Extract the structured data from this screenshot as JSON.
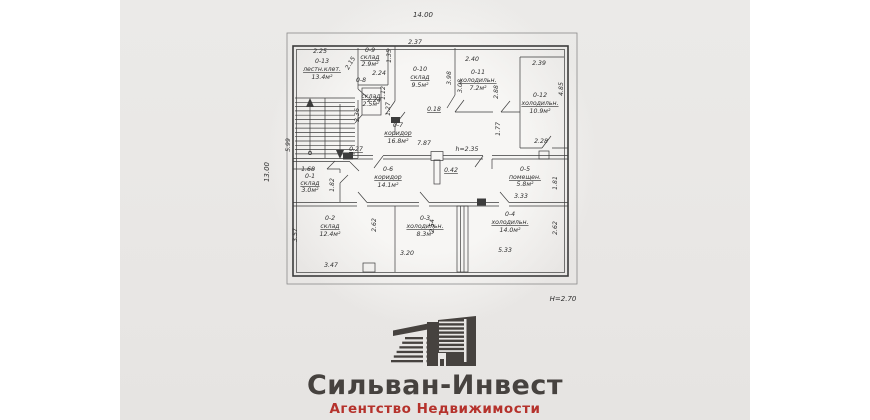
{
  "plan": {
    "width_label": "14.00",
    "depth_label": "13.00",
    "height_label": "H=2.70",
    "rooms": [
      {
        "id": "0-13",
        "name": "лестн.клет.",
        "area": "13.4м²"
      },
      {
        "id": "0-9",
        "name": "склад",
        "area": "2.9м²"
      },
      {
        "id": "0-8",
        "name": "склад",
        "area": "2.5м²"
      },
      {
        "id": "0-10",
        "name": "склад",
        "area": "9.5м²"
      },
      {
        "id": "0-11",
        "name": "холодильн.",
        "area": "7.2м²"
      },
      {
        "id": "0-12",
        "name": "холодильн.",
        "area": "10.9м²"
      },
      {
        "id": "0-7",
        "name": "коридор",
        "area": "16.8м²"
      },
      {
        "id": "0-1",
        "name": "склад",
        "area": "3.0м²"
      },
      {
        "id": "0-6",
        "name": "коридор",
        "area": "14.1м²"
      },
      {
        "id": "0-5",
        "name": "помещен.",
        "area": "5.8м²"
      },
      {
        "id": "0-2",
        "name": "склад",
        "area": "12.4м²"
      },
      {
        "id": "0-3",
        "name": "холодильн.",
        "area": "8.3м²"
      },
      {
        "id": "0-4",
        "name": "холодильн.",
        "area": "14.0м²"
      }
    ],
    "dims": {
      "d_2_25": "2.25",
      "d_5_99": "5.99",
      "d_2_15": "2.15",
      "d_1_35": "1.35",
      "d_2_37": "2.37",
      "d_2_24a": "2.24",
      "d_1_12": "1.12",
      "d_2_24b": "2.24",
      "d_1_27": "1.27",
      "d_3_98": "3.98",
      "d_0_18": "0.18",
      "d_2_40": "2.40",
      "d_3_08": "3.08",
      "d_2_88": "2.88",
      "d_2_39": "2.39",
      "d_4_85": "4.85",
      "d_1_77": "1.77",
      "d_2_28": "2.28",
      "d_0_27": "0.27",
      "d_7_87": "7.87",
      "h_2_35": "h=2.35",
      "d_1_68": "1.68",
      "d_1_82": "1.82",
      "d_0_42": "0.42",
      "d_3_33": "3.33",
      "d_1_81": "1.81",
      "d_3_57": "3.57",
      "d_3_47": "3.47",
      "d_2_62a": "2.62",
      "d_3_20": "3.20",
      "d_2_54": "2.54",
      "d_5_33": "5.33",
      "d_2_62b": "2.62",
      "d_3_36": "3.36"
    }
  },
  "logo": {
    "title": "Сильван-Инвест",
    "subtitle": "Агентство Недвижимости"
  },
  "colors": {
    "panel_bg": "#e9e7e5",
    "plan_ink": "#3c3c3c",
    "logo_title": "#46423f",
    "logo_subtitle": "#b5322c"
  }
}
